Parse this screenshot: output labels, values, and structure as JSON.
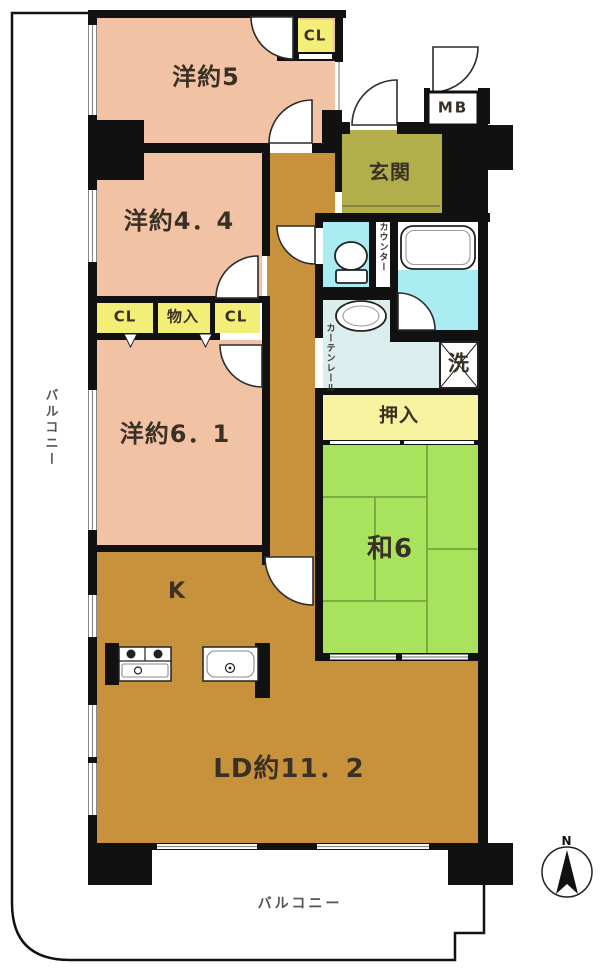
{
  "colors": {
    "wall": "#111111",
    "pink": "#f2c2a4",
    "brown": "#c8913c",
    "olive": "#b2ae4c",
    "green": "#a9e35e",
    "yellow": "#f6f2a0",
    "yellow_bright": "#f3ee78",
    "cyan": "#a9ecf2",
    "pale_cyan": "#dcedee",
    "tatami_line": "#79ad3f",
    "text": "#3a3126"
  },
  "rooms": {
    "yo5": "洋約5",
    "yo44": "洋約4．4",
    "yo61": "洋約6．1",
    "wa6": "和6",
    "kitchen": "K",
    "ld": "LD約11．2",
    "genkan": "玄関",
    "oshiire": "押入"
  },
  "closets": {
    "cl_top": "CL",
    "cl_left": "CL",
    "monoire": "物入",
    "cl_right": "CL"
  },
  "labels": {
    "meter_box": "MB",
    "laundry": "洗",
    "counter": "カウンター",
    "curtain_rail": "カーテンレール",
    "balcony_left": "バルコニー",
    "balcony_bottom": "バルコニー",
    "compass_north": "N"
  }
}
